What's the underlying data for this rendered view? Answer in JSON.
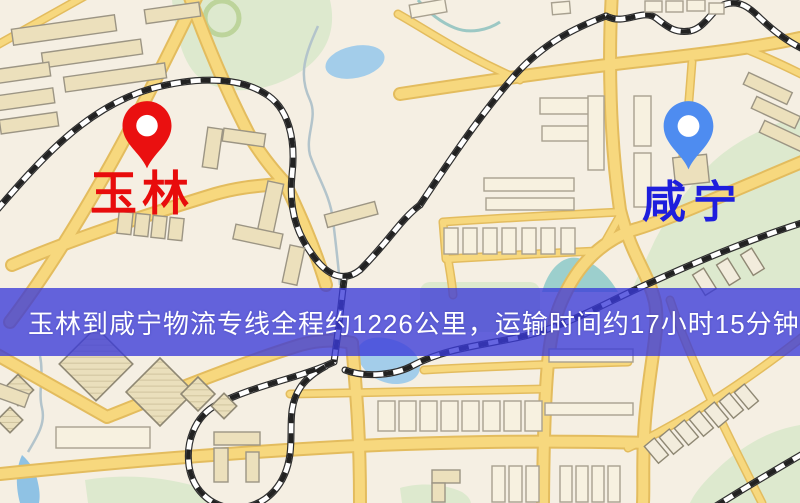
{
  "map": {
    "origin": {
      "name": "玉林",
      "pin_color": "#ea1010",
      "label_color": "#e80c0c"
    },
    "destination": {
      "name": "咸宁",
      "pin_color": "#4e8cf0",
      "label_color": "#1e1edd"
    }
  },
  "banner": {
    "text": "玉林到咸宁物流专线全程约1226公里，运输时间约17小时15分钟.",
    "route_from": "玉林",
    "route_to": "咸宁",
    "distance_km": "1226",
    "duration": "17小时15分钟",
    "background_color": "#3a3ad8",
    "text_color": "#ffffff"
  },
  "palette": {
    "land": "#f5efe3",
    "road_fill": "#f7d87e",
    "road_casing": "#e3bc5e",
    "park": "#dde9ce",
    "water": "#a3cdea",
    "building": "#ece0bc",
    "railway": "#2b2b2b"
  }
}
